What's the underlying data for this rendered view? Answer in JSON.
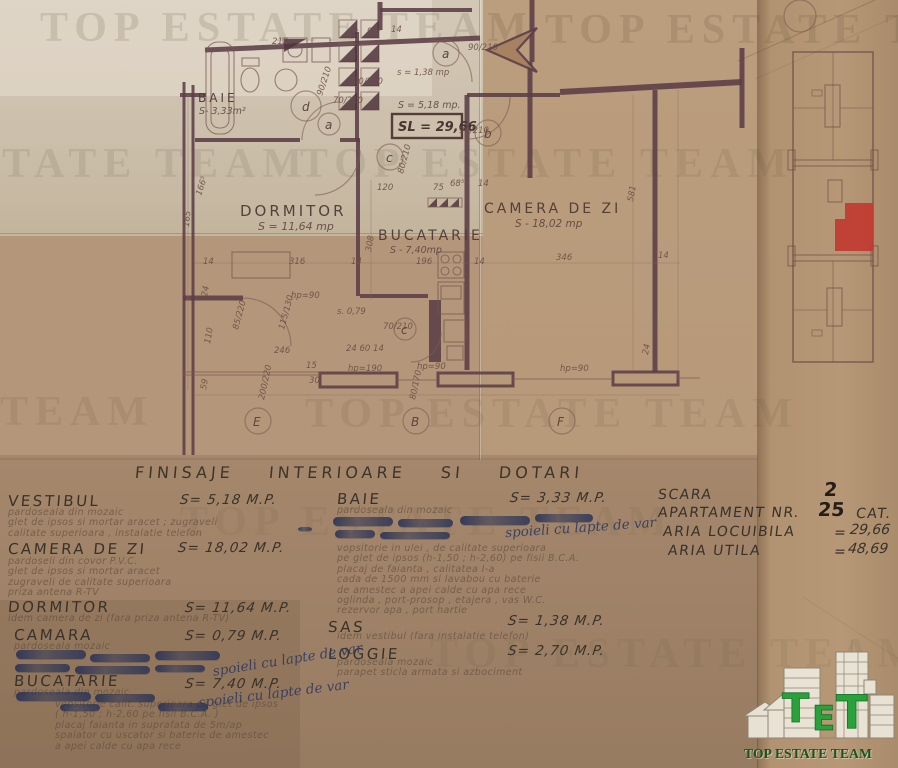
{
  "colors": {
    "paper": "#b4967a",
    "plan_line": "#5b3d47",
    "ink_blue": "#303a63",
    "unit_red": "#c13a31",
    "logo_green": "#2aa13a",
    "logo_text_green": "#14561d"
  },
  "watermark": {
    "text": "TOP ESTATE TEAM"
  },
  "plan": {
    "rooms": {
      "baie": {
        "name": "BAIE",
        "area": "S- 3,33m²"
      },
      "dormitor": {
        "name": "DORMITOR",
        "area": "S = 11,64 mp"
      },
      "bucatarie": {
        "name": "BUCATARIE",
        "area": "S - 7,40mp"
      },
      "camera_de_zi": {
        "name": "CAMERA DE ZI",
        "area": "S - 18,02 mp"
      }
    },
    "vestibul_area": "S = 5,18 mp.",
    "sl_total": "SL = 29,66",
    "doors": [
      "d",
      "a",
      "c",
      "b",
      "a",
      "c"
    ],
    "sections": [
      "E",
      "B",
      "F"
    ],
    "dims": [
      "212",
      "75",
      "93⁵",
      "14",
      "90/210",
      "70/210",
      "90/210",
      "90/210",
      "80/210",
      "120",
      "68⁵",
      "14",
      "75",
      "s = 1,38 mp",
      "90/210",
      "S = 5,18 mp.",
      "14",
      "316",
      "14",
      "196",
      "14",
      "346",
      "14",
      "581",
      "308",
      "hp=90",
      "s. 0,79",
      "70/210",
      "246",
      "24  60  14",
      "110",
      "85/220",
      "115/130",
      "15",
      "30",
      "hp=190",
      "hp=90",
      "hp=90",
      "200/220",
      "59",
      "80/170",
      "24",
      "165",
      "166⁵",
      "24"
    ]
  },
  "finishes": {
    "title": "FINISAJE INTERIOARE SI DOTARI",
    "annotation_text": "spoieli cu lapte de var",
    "left": [
      {
        "name": "VESTIBUL",
        "area": "S= 5,18 M.P.",
        "lines": [
          "pardoseala din mozaic",
          "glet de ipsos si mortar aracet ; zugraveli",
          "calitate superioara , instalatie telefon"
        ]
      },
      {
        "name": "CAMERA  DE  ZI",
        "area": "S= 18,02 M.P.",
        "lines": [
          "pardoseli din covor P.V.C.",
          "glet de ipsos si mortar aracet",
          "zugraveli de calitate superioara",
          "priza antena R-TV"
        ]
      },
      {
        "name": "DORMITOR",
        "area": "S= 11,64 M.P.",
        "lines": [
          "idem camera de zi (fara priza antena R-TV)"
        ]
      },
      {
        "name": "CAMARA",
        "area": "S= 0,79 M.P.",
        "lines": [
          "pardoseala mozaic"
        ]
      },
      {
        "name": "BUCATARIE",
        "area": "S= 7,40 M.P.",
        "lines": [
          "pardoseala din mozaic",
          "vopsitorie calit. superioara pe glet de ipsos",
          "( h-1,50 ; h-2,60  pe fisii  B.C.A. )",
          "placaj faianta in suprafata de 5m/ap",
          "spalator cu uscator si baterie de amestec",
          "a apei calde cu apa rece"
        ]
      }
    ],
    "right": [
      {
        "name": "BAIE",
        "area": "S= 3,33 M.P.",
        "lines": [
          "pardoseala din mozaic",
          "vopsitorie in ulei , de calitate superioara",
          "pe glet de ipsos (h-1,50 ; h-2,60) pe fisii B.C.A.",
          "placaj de faianta , calitatea I-a",
          "cada de 1500 mm si lavabou cu baterie",
          "de amestec a apei calde cu apa rece",
          "oglinda , port-prosop , etajera , vas W.C.",
          "rezervor apa , port hartie"
        ]
      },
      {
        "name": "SAS",
        "area": "S= 1,38 M.P.",
        "lines": [
          "idem vestibul (fara instalatie telefon)"
        ]
      },
      {
        "name": "LOGGIE",
        "area": "S= 2,70 M.P.",
        "lines": [
          "pardoseala mozaic",
          "parapet sticla armata si azbociment"
        ]
      }
    ]
  },
  "summary": {
    "scara_label": "SCARA",
    "scara_value": "2",
    "apartament_label": "APARTAMENT  NR.",
    "apartament_value": "25",
    "cat_label": "CAT.",
    "rows": [
      {
        "label": "ARIA  LOCUIBILA",
        "eq": "=",
        "value": "29,66"
      },
      {
        "label": "ARIA  UTILA",
        "eq": "=",
        "value": "48,69"
      }
    ]
  },
  "logo": {
    "t1": "T",
    "t2": "E",
    "t3": "T",
    "caption": "TOP ESTATE TEAM"
  }
}
